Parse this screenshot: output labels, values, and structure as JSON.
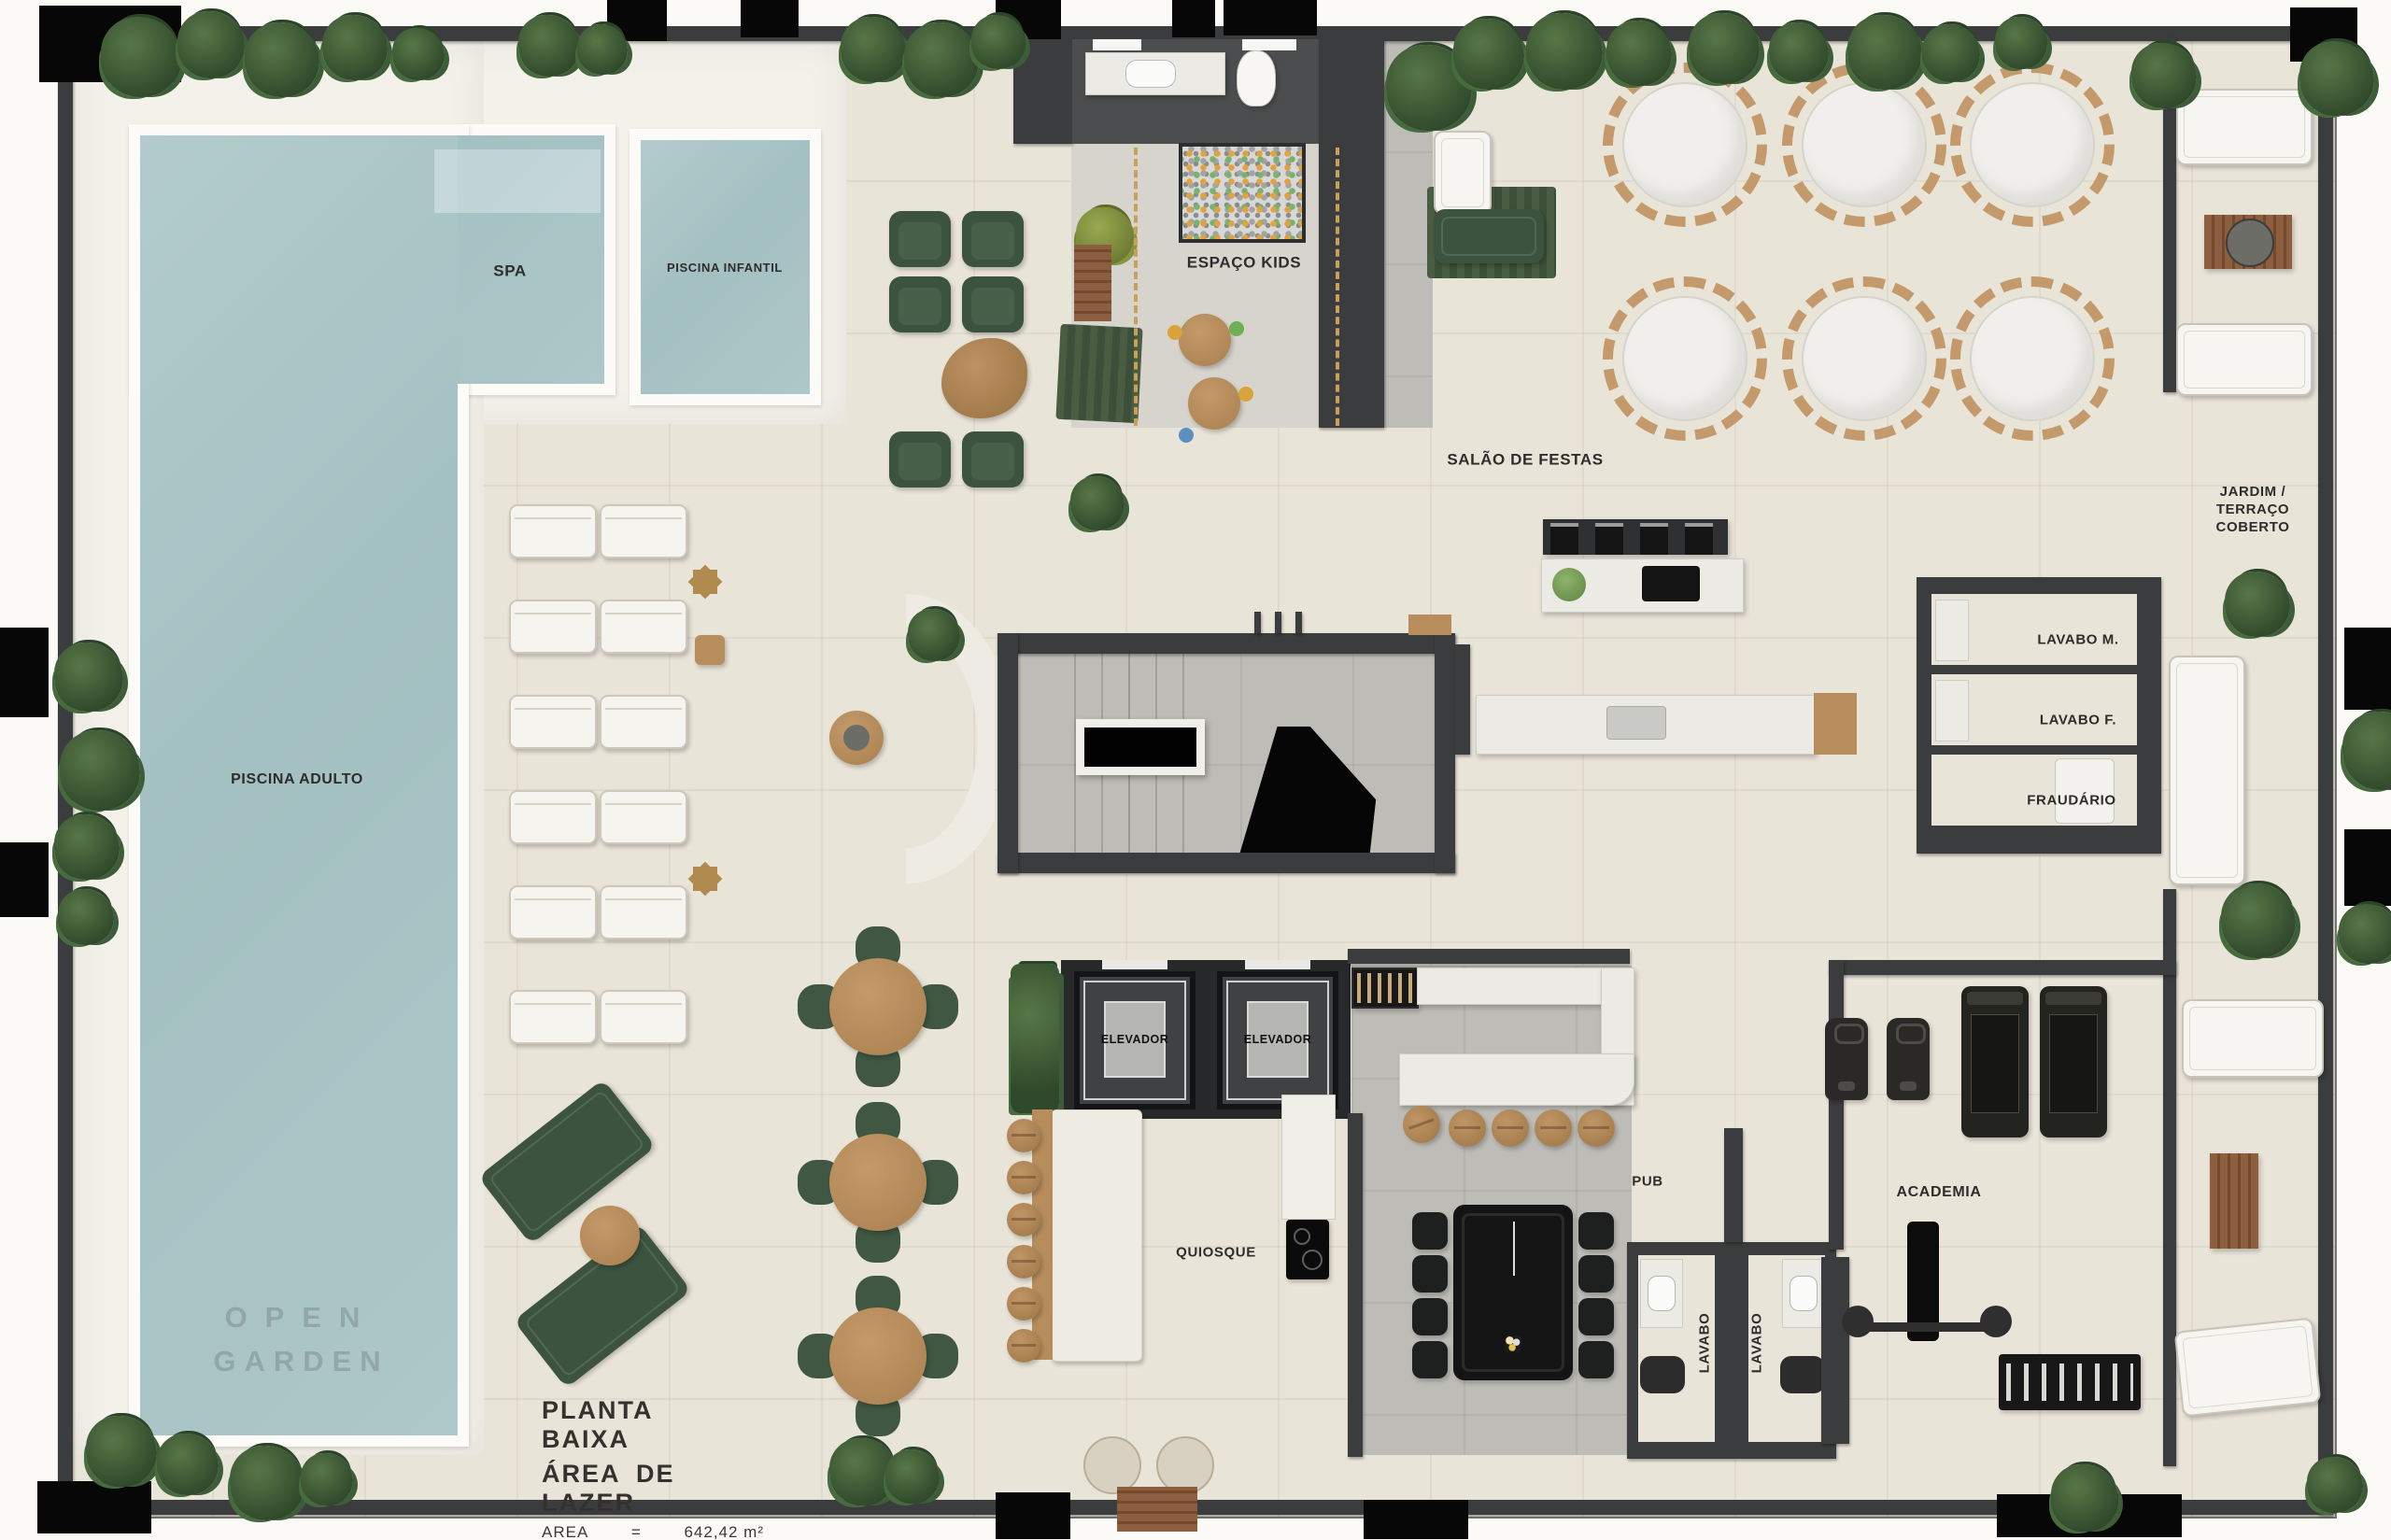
{
  "plan": {
    "watermark": {
      "line1": "OPEN",
      "line2": "GARDEN"
    },
    "title_block": {
      "title": "PLANTA BAIXA",
      "subtitle": "ÁREA DE LAZER",
      "area_label": "AREA",
      "area_equals": "=",
      "area_value": "642,42 m²"
    },
    "rooms": {
      "spa": "SPA",
      "piscina_infantil": "PISCINA INFANTIL",
      "piscina_adulto": "PISCINA ADULTO",
      "espaco_kids": "ESPAÇO KIDS",
      "salao_de_festas": "SALÃO DE FESTAS",
      "jardim_terraco": "JARDIM /\nTERRAÇO\nCOBERTO",
      "lavabo_m": "LAVABO M.",
      "lavabo_f": "LAVABO F.",
      "fraudario": "FRAUDÁRIO",
      "elevador": "ELEVADOR",
      "quiosque": "QUIOSQUE",
      "pub": "PUB",
      "academia": "ACADEMIA",
      "lavabo": "LAVABO"
    },
    "colors": {
      "floor": "#e9e4d8",
      "deck": "#f3f1ea",
      "water": "#aac4c6",
      "wall": "#3a3c3e",
      "greenery": "#3d5a35",
      "wood": "#b78d5c",
      "sofa_green": "#3c5340",
      "marble": "#eceae4",
      "concrete": "#bdbcb7",
      "label_text": "#2e2d2b"
    }
  }
}
